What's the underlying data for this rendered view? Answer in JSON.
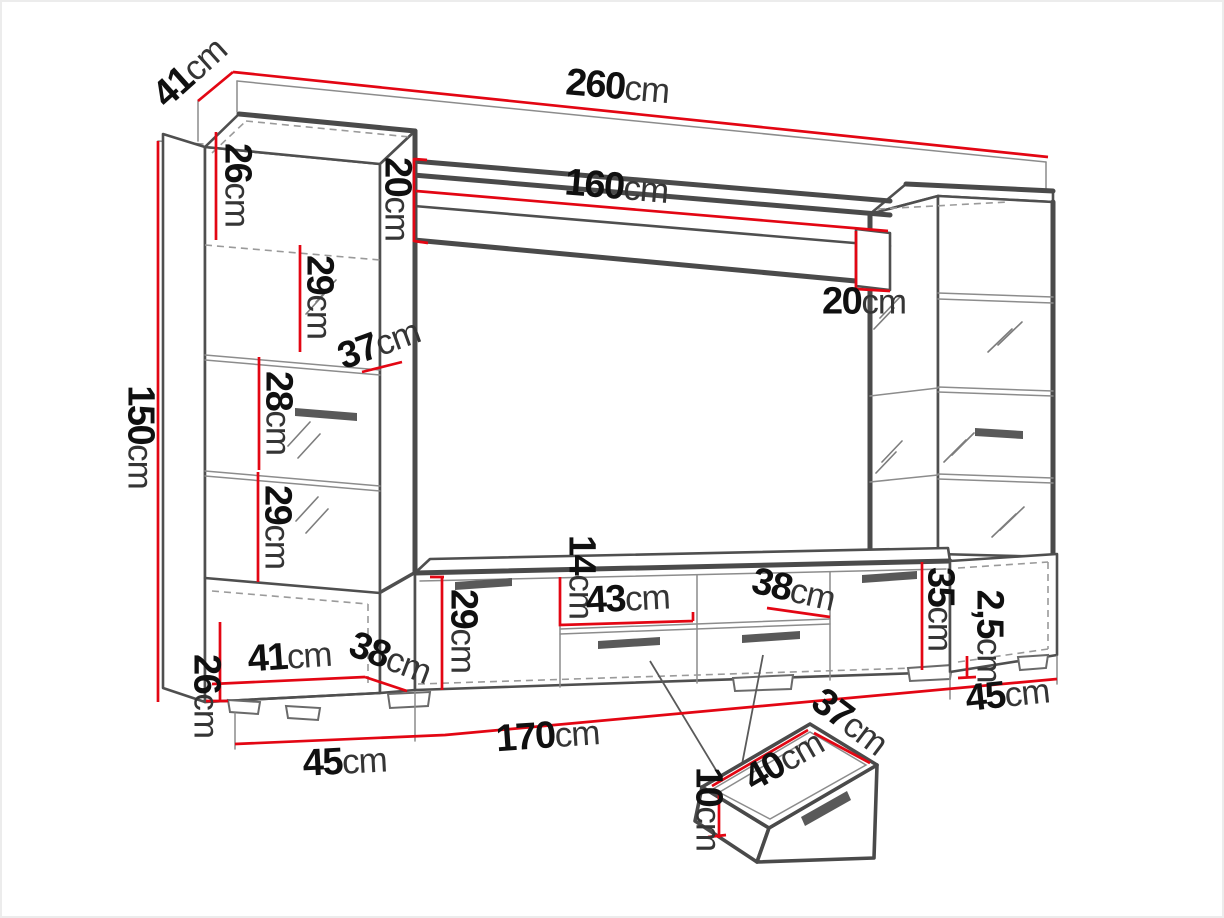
{
  "document": {
    "type": "furniture-dimension-diagram",
    "subject": "wall unit entertainment center with red dimension lines",
    "background": "#ffffff"
  },
  "colors": {
    "dimension_line": "#e30613",
    "outline": "#4f4f4f",
    "hidden_line": "#9a9a9a",
    "label_number": "#101010",
    "label_unit": "#353535"
  },
  "labels": [
    {
      "id": "overall-width",
      "num": "260",
      "unit": "cm",
      "x": 617,
      "y": 93,
      "rot": 5
    },
    {
      "id": "top-depth",
      "num": "41",
      "unit": "cm",
      "x": 194,
      "y": 77,
      "rot": -42
    },
    {
      "id": "overall-height",
      "num": "150",
      "unit": "cm",
      "x": 134,
      "y": 437,
      "rot": 90
    },
    {
      "id": "top-cabinet-height",
      "num": "26",
      "unit": "cm",
      "x": 231,
      "y": 185,
      "rot": 90
    },
    {
      "id": "shelf-left-height",
      "num": "20",
      "unit": "cm",
      "x": 391,
      "y": 199,
      "rot": 90
    },
    {
      "id": "shelf-length",
      "num": "160",
      "unit": "cm",
      "x": 616,
      "y": 193,
      "rot": 4.8
    },
    {
      "id": "shelf-right-height",
      "num": "20",
      "unit": "cm",
      "x": 864,
      "y": 308,
      "rot": 0
    },
    {
      "id": "left-shelf-gap-top",
      "num": "29",
      "unit": "cm",
      "x": 313,
      "y": 297,
      "rot": 90
    },
    {
      "id": "left-cabinet-depth",
      "num": "37",
      "unit": "cm",
      "x": 381,
      "y": 350,
      "rot": -20
    },
    {
      "id": "left-shelf-gap-mid",
      "num": "28",
      "unit": "cm",
      "x": 272,
      "y": 413,
      "rot": 90
    },
    {
      "id": "left-shelf-gap-low",
      "num": "29",
      "unit": "cm",
      "x": 271,
      "y": 527,
      "rot": 90
    },
    {
      "id": "base-left-height",
      "num": "26",
      "unit": "cm",
      "x": 200,
      "y": 696,
      "rot": 90
    },
    {
      "id": "base-left-width",
      "num": "41",
      "unit": "cm",
      "x": 290,
      "y": 663,
      "rot": -4
    },
    {
      "id": "base-left-depth",
      "num": "38",
      "unit": "cm",
      "x": 388,
      "y": 664,
      "rot": 21
    },
    {
      "id": "base-left-floor",
      "num": "45",
      "unit": "cm",
      "x": 345,
      "y": 768,
      "rot": -3
    },
    {
      "id": "tv-stand-length",
      "num": "170",
      "unit": "cm",
      "x": 548,
      "y": 742,
      "rot": -4
    },
    {
      "id": "tv-left-door-height",
      "num": "29",
      "unit": "cm",
      "x": 457,
      "y": 631,
      "rot": 90
    },
    {
      "id": "niche-height",
      "num": "14",
      "unit": "cm",
      "x": 575,
      "y": 577,
      "rot": 90
    },
    {
      "id": "niche-left-width",
      "num": "43",
      "unit": "cm",
      "x": 628,
      "y": 605,
      "rot": -3
    },
    {
      "id": "niche-right-width",
      "num": "38",
      "unit": "cm",
      "x": 792,
      "y": 596,
      "rot": 13
    },
    {
      "id": "tv-right-door-height",
      "num": "35",
      "unit": "cm",
      "x": 934,
      "y": 609,
      "rot": 90
    },
    {
      "id": "plinth-height",
      "num": "2,5",
      "unit": "cm",
      "x": 983,
      "y": 636,
      "rot": 90
    },
    {
      "id": "base-right-floor",
      "num": "45",
      "unit": "cm",
      "x": 1008,
      "y": 701,
      "rot": -6
    },
    {
      "id": "drawer-depth",
      "num": "37",
      "unit": "cm",
      "x": 846,
      "y": 727,
      "rot": 37
    },
    {
      "id": "drawer-width",
      "num": "40",
      "unit": "cm",
      "x": 787,
      "y": 766,
      "rot": -30
    },
    {
      "id": "drawer-height",
      "num": "10",
      "unit": "cm",
      "x": 702,
      "y": 809,
      "rot": 90
    }
  ],
  "dimensions_summary": {
    "overall_width_cm": 260,
    "overall_height_cm": 150,
    "top_depth_cm": 41,
    "wall_shelf_length_cm": 160,
    "wall_shelf_end_height_cm": 20,
    "tall_cabinet_top_section_cm": 26,
    "tall_cabinet_shelf_gaps_cm": [
      29,
      28,
      29
    ],
    "tall_cabinet_depth_cm": 37,
    "base_left_height_cm": 26,
    "base_left_width_cm": 41,
    "base_left_depth_cm": 38,
    "base_left_floor_cm": 45,
    "tv_stand_length_cm": 170,
    "tv_stand_left_door_cm": 29,
    "niche_height_cm": 14,
    "niche_left_width_cm": 43,
    "niche_right_width_cm": 38,
    "tv_stand_right_door_cm": 35,
    "plinth_height_cm": "2,5",
    "base_right_floor_cm": 45,
    "drawer_width_cm": 40,
    "drawer_depth_cm": 37,
    "drawer_height_cm": 10
  }
}
